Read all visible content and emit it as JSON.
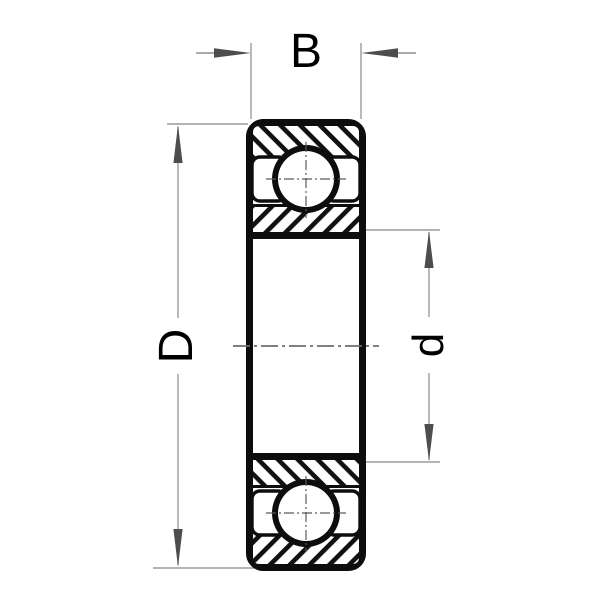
{
  "diagram": {
    "type": "ball-bearing-cross-section-drawing",
    "dimensions": {
      "width": {
        "label": "B"
      },
      "outer_diameter": {
        "label": "D"
      },
      "bore_diameter": {
        "label": "d"
      }
    },
    "colors": {
      "outline": "#0d0d0d",
      "hatch": "#111111",
      "dimension_line": "#9b9b9b",
      "arrow": "#4d4d4d",
      "centerline": "#6e6e6e",
      "label_text": "#000000",
      "background": "#ffffff"
    }
  }
}
